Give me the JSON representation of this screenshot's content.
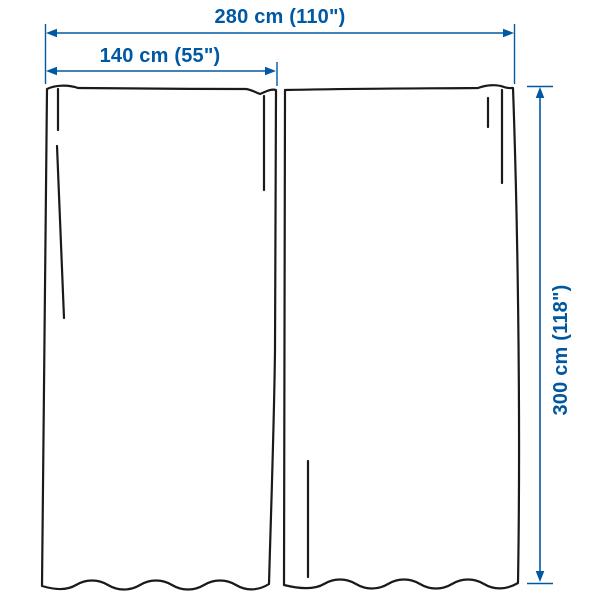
{
  "diagram": {
    "title": "curtain-pair-measurement-diagram",
    "product_type": "curtains, 1 pair of panels",
    "panels_count": 2,
    "dimensions": {
      "total_width": {
        "label": "280 cm (110\")",
        "value_cm": 280,
        "value_in": 110
      },
      "panel_width": {
        "label": "140 cm (55\")",
        "value_cm": 140,
        "value_in": 55
      },
      "height": {
        "label": "300 cm (118\")",
        "value_cm": 300,
        "value_in": 118
      }
    }
  },
  "colors": {
    "dimension": "#0058A3",
    "outline": "#1a1a1a",
    "background": "#ffffff"
  }
}
